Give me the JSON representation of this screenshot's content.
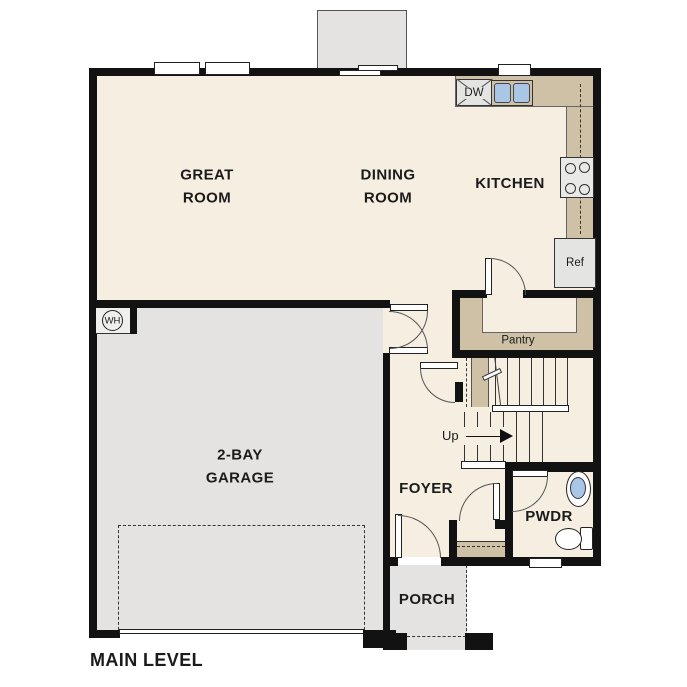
{
  "plan": {
    "title": "MAIN LEVEL",
    "rooms": {
      "great_room": "GREAT ROOM",
      "dining_room": "DINING ROOM",
      "kitchen": "KITCHEN",
      "garage": "2-BAY GARAGE",
      "foyer": "FOYER",
      "powder_room": "PWDR",
      "porch": "PORCH",
      "pantry": "Pantry"
    },
    "labels": {
      "dishwasher": "DW",
      "refrigerator": "Ref",
      "water_heater": "WH",
      "stairs_direction": "Up"
    },
    "colors": {
      "floor": "#f5eee1",
      "concrete": "#e4e3e1",
      "counter": "#cec1a6",
      "fixture-blue": "#a9c7e5",
      "wall": "#121212",
      "line": "#444444",
      "text": "#1b1b1b"
    }
  }
}
